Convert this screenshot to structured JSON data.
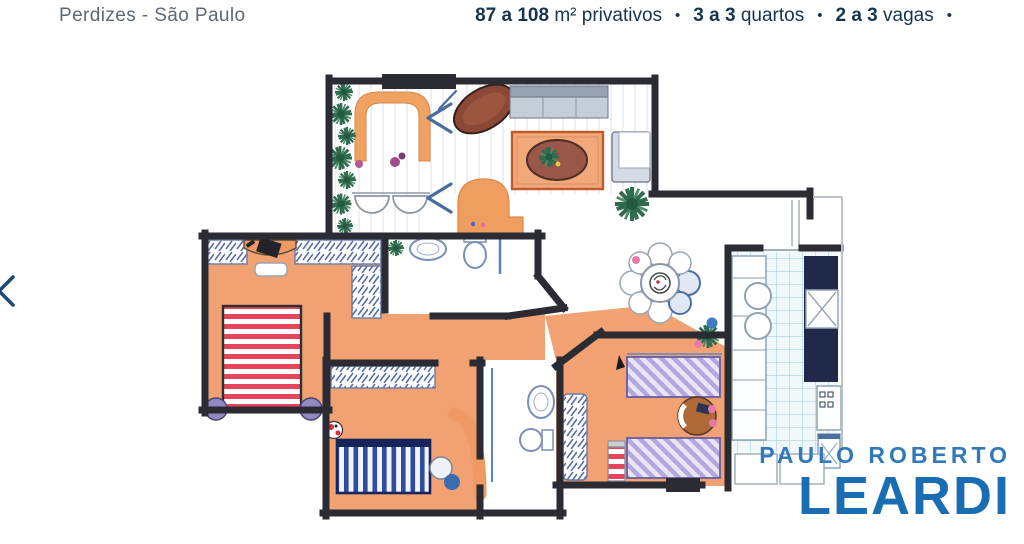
{
  "header": {
    "location": "Perdizes - São Paulo",
    "dot": "•",
    "specs": [
      {
        "bold": "87 a 108",
        "rest": " m² privativos"
      },
      {
        "bold": "3 a 3",
        "rest": " quartos"
      },
      {
        "bold": "2 a 3",
        "rest": " vagas"
      }
    ]
  },
  "carousel": {
    "prev_icon": "chevron-left"
  },
  "watermark": {
    "line1": "PAULO ROBERTO",
    "line2": "LEARDI"
  },
  "floorplan": {
    "description": "hand-drawn colored apartment floor plan",
    "rooms": [
      "varanda",
      "living",
      "jantar",
      "cozinha",
      "dormitorio-casal",
      "dormitorio-2",
      "dormitorio-3",
      "banheiro-1",
      "banheiro-2",
      "hall",
      "area-servico"
    ],
    "palette": {
      "wall": "#2b2b33",
      "floor_orange": "#f1a172",
      "tile_blue_bg": "#f0f8fa",
      "tile_blue_line": "#a6d4e2",
      "counter_navy": "#20294a",
      "bed_red_stripe": "#e6445a",
      "bed_blue_stripe": "#2d4da0",
      "bed_purple": "#b3a8de",
      "door_mark_blue": "#4a6b9d",
      "header_navy": "#16344f",
      "logo_blue_light": "#3079bb",
      "logo_blue_dark": "#1b6db3"
    }
  }
}
